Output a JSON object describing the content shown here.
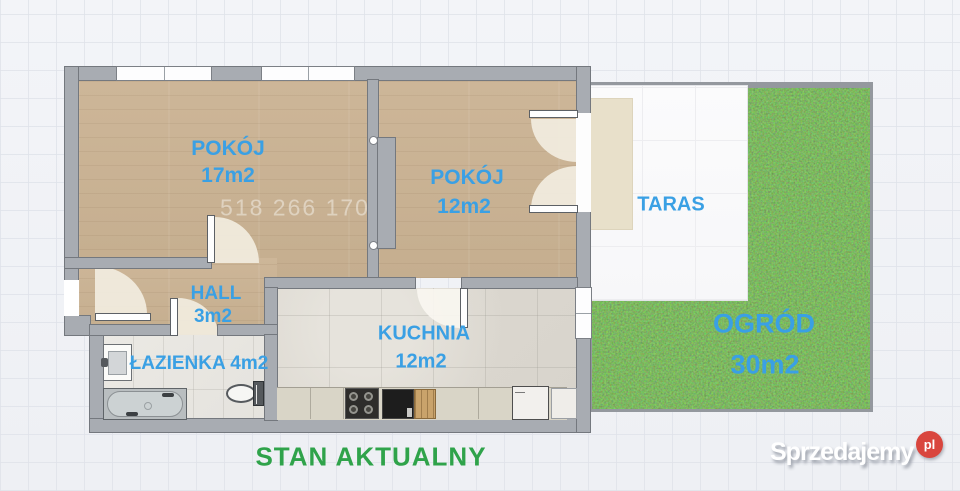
{
  "rooms": {
    "room1": {
      "name": "POKÓJ",
      "area": "17m2"
    },
    "room2": {
      "name": "POKÓJ",
      "area": "12m2"
    },
    "taras": {
      "name": "TARAS"
    },
    "hall": {
      "name": "HALL",
      "area": "3m2"
    },
    "bathroom": {
      "name": "ŁAZIENKA",
      "area": "4m2"
    },
    "kitchen": {
      "name": "KUCHNIA",
      "area": "12m2"
    },
    "garden": {
      "name": "OGRÓD",
      "area": "30m2"
    }
  },
  "watermark": "518 266 170",
  "caption": "STAN AKTUALNY",
  "logo": {
    "text": "Sprzedajemy",
    "suffix": "pl"
  },
  "colors": {
    "label_blue": "#3aa0e4",
    "caption_green": "#2fa34a",
    "logo_red": "#d9463e",
    "wall_gray": "#a8acb2",
    "wood": "#c9b295",
    "grass": "#4f9c33"
  }
}
